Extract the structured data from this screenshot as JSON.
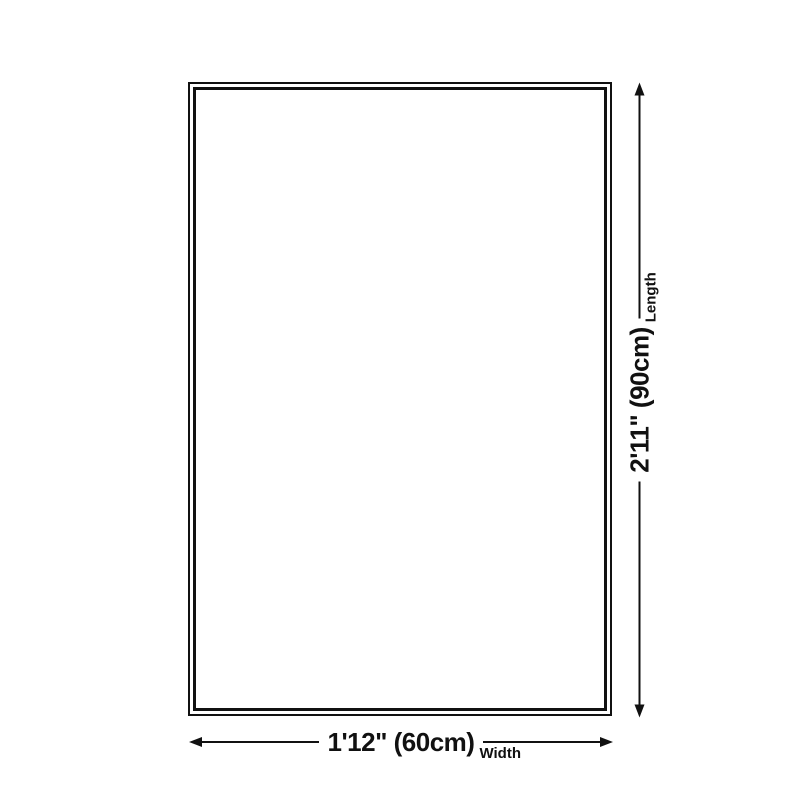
{
  "page": {
    "background_color": "#ffffff",
    "line_color": "#111111"
  },
  "diagram": {
    "type": "product-size-diagram",
    "shape": "rectangle",
    "width_dimension": {
      "value": "1'12\" (60cm)",
      "label": "Width"
    },
    "length_dimension": {
      "value": "2'11\" (90cm)",
      "label": "Length"
    }
  }
}
